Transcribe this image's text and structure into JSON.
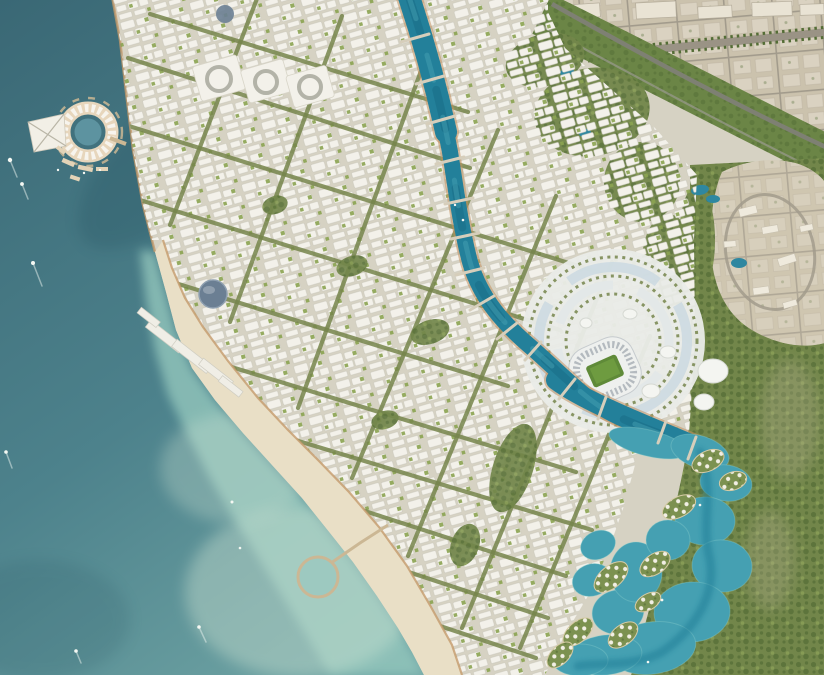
{
  "scene": {
    "title": "Coastal city masterplan — aerial render",
    "description": "Bird's-eye architectural rendering of a new waterfront city: dark teal sea with boats on the left, a circular marina island resort connected to shore, a dense white low-rise city crossed by tree-lined boulevards, a winding turquoise canal flowing from the north down past a stadium entertainment district, a crescent beach with a circular swimming pier, a mangrove lagoon with villa islands in the south-east, a green parkway belt separating the new city from an existing beige desert town in the north-east, and a rocky hillside village on the eastern edge.",
    "landmarks": [
      "circular marina island resort",
      "triangular barge pier",
      "winding central canal with bridges",
      "stadium with green pitch and sports district",
      "white dome venues",
      "crescent beach with circular pier",
      "lagoon with villa islands",
      "mangrove forest",
      "desert town grid (north-east)",
      "green parkway belt with highway",
      "hillside village (east)",
      "blue dome landmark building",
      "courtyard superblocks",
      "boats with wakes"
    ]
  },
  "palette": {
    "ocean_deep": "#3a6875",
    "ocean_mid": "#4d828c",
    "ocean_light": "#79aeab",
    "water_shadow": "#1f4a59",
    "shallow": "#93c6bc",
    "sand_shallow": "#cfe4d3",
    "sand": "#e9dfc6",
    "coast_edge": "#c49a6a",
    "ground": "#d6d2c3",
    "building": "#f3f1ea",
    "green_street": "#75854b",
    "green_park": "#8ba351",
    "green_dark": "#546d36",
    "forest": "#72864a",
    "belt": "#6b8546",
    "highway": "#7e8073",
    "canal": "#23809a",
    "canal_deep": "#14607a",
    "canal_light": "#4aa4b6",
    "canal_bank": "#c1905f",
    "lagoon": "#45a0b2",
    "lagoon_deep": "#1e7c95",
    "desert": "#cbc2ad",
    "desert_plot": "#ddd6c6",
    "desert_road": "#a29b8c",
    "rock": "#cfc6b0",
    "plaza": "#e9ebe7",
    "plaza_blue": "#c9d8e1",
    "stands": "#eef0ee",
    "stands_ring": "#a9b0b6",
    "pitch": "#5f8a38",
    "pitch_light": "#73a043",
    "marina_ring": "#e7d6bc",
    "marina_white": "#f7f4ed",
    "pier_tan": "#cbb794",
    "dome_blue": "#6b7f93",
    "villa_green": "#7c9150",
    "forest_road": "#b3a98d",
    "boat": "#f5f8f3"
  },
  "features": {
    "boulevards": [
      {
        "tag": "line",
        "x1": 150,
        "y1": 14,
        "x2": 468,
        "y2": 112
      },
      {
        "tag": "line",
        "x1": 128,
        "y1": 58,
        "x2": 470,
        "y2": 168
      },
      {
        "tag": "line",
        "x1": 116,
        "y1": 122,
        "x2": 604,
        "y2": 274
      },
      {
        "tag": "line",
        "x1": 140,
        "y1": 200,
        "x2": 560,
        "y2": 330
      },
      {
        "tag": "line",
        "x1": 172,
        "y1": 282,
        "x2": 508,
        "y2": 386
      },
      {
        "tag": "line",
        "x1": 215,
        "y1": 362,
        "x2": 576,
        "y2": 472
      },
      {
        "tag": "line",
        "x1": 262,
        "y1": 430,
        "x2": 592,
        "y2": 530
      },
      {
        "tag": "line",
        "x1": 312,
        "y1": 494,
        "x2": 566,
        "y2": 576
      },
      {
        "tag": "line",
        "x1": 360,
        "y1": 556,
        "x2": 548,
        "y2": 618
      },
      {
        "tag": "line",
        "x1": 404,
        "y1": 614,
        "x2": 536,
        "y2": 658
      },
      {
        "tag": "line",
        "x1": 258,
        "y1": -4,
        "x2": 170,
        "y2": 225
      },
      {
        "tag": "line",
        "x1": 342,
        "y1": 16,
        "x2": 230,
        "y2": 322
      },
      {
        "tag": "line",
        "x1": 425,
        "y1": 60,
        "x2": 298,
        "y2": 408
      },
      {
        "tag": "line",
        "x1": 498,
        "y1": 130,
        "x2": 352,
        "y2": 478
      },
      {
        "tag": "line",
        "x1": 556,
        "y1": 196,
        "x2": 408,
        "y2": 556
      },
      {
        "tag": "line",
        "x1": 612,
        "y1": 262,
        "x2": 462,
        "y2": 628
      },
      {
        "tag": "line",
        "x1": 650,
        "y1": 336,
        "x2": 520,
        "y2": 648
      }
    ],
    "bridges": [
      {
        "tag": "line",
        "x1": 401,
        "y1": 42,
        "x2": 429,
        "y2": 34
      },
      {
        "tag": "line",
        "x1": 416,
        "y1": 84,
        "x2": 444,
        "y2": 76
      },
      {
        "tag": "line",
        "x1": 427,
        "y1": 124,
        "x2": 455,
        "y2": 116
      },
      {
        "tag": "line",
        "x1": 436,
        "y1": 164,
        "x2": 464,
        "y2": 157
      },
      {
        "tag": "line",
        "x1": 445,
        "y1": 204,
        "x2": 473,
        "y2": 198
      },
      {
        "tag": "line",
        "x1": 451,
        "y1": 239,
        "x2": 479,
        "y2": 233
      },
      {
        "tag": "line",
        "x1": 456,
        "y1": 275,
        "x2": 484,
        "y2": 268
      },
      {
        "tag": "line",
        "x1": 470,
        "y1": 310,
        "x2": 494,
        "y2": 296
      },
      {
        "tag": "line",
        "x1": 497,
        "y1": 339,
        "x2": 517,
        "y2": 323
      },
      {
        "tag": "line",
        "x1": 525,
        "y1": 360,
        "x2": 541,
        "y2": 342
      },
      {
        "tag": "line",
        "x1": 559,
        "y1": 399,
        "x2": 575,
        "y2": 379
      },
      {
        "tag": "line",
        "x1": 598,
        "y1": 419,
        "x2": 606,
        "y2": 397
      },
      {
        "tag": "line",
        "x1": 658,
        "y1": 443,
        "x2": 666,
        "y2": 421
      },
      {
        "tag": "line",
        "x1": 688,
        "y1": 459,
        "x2": 696,
        "y2": 437
      }
    ],
    "lagoon_pools": [
      {
        "tag": "ellipse",
        "cx": 648,
        "cy": 443,
        "rx": 40,
        "ry": 13,
        "transform": "rotate(14 648 443)"
      },
      {
        "tag": "ellipse",
        "cx": 700,
        "cy": 452,
        "rx": 30,
        "ry": 16,
        "transform": "rotate(18 700 452)"
      },
      {
        "tag": "ellipse",
        "cx": 726,
        "cy": 483,
        "rx": 26,
        "ry": 18,
        "transform": "rotate(8 726 483)"
      },
      {
        "tag": "ellipse",
        "cx": 705,
        "cy": 521,
        "rx": 30,
        "ry": 24
      },
      {
        "tag": "ellipse",
        "cx": 722,
        "cy": 566,
        "rx": 30,
        "ry": 26,
        "transform": "rotate(6 722 566)"
      },
      {
        "tag": "ellipse",
        "cx": 692,
        "cy": 612,
        "rx": 38,
        "ry": 30,
        "transform": "rotate(-4 692 612)"
      },
      {
        "tag": "ellipse",
        "cx": 652,
        "cy": 648,
        "rx": 44,
        "ry": 26,
        "transform": "rotate(-8 652 648)"
      },
      {
        "tag": "ellipse",
        "cx": 606,
        "cy": 655,
        "rx": 36,
        "ry": 20,
        "transform": "rotate(-6 606 655)"
      },
      {
        "tag": "ellipse",
        "cx": 580,
        "cy": 660,
        "rx": 28,
        "ry": 16
      },
      {
        "tag": "ellipse",
        "cx": 618,
        "cy": 612,
        "rx": 26,
        "ry": 22,
        "transform": "rotate(-12 618 612)"
      },
      {
        "tag": "ellipse",
        "cx": 592,
        "cy": 580,
        "rx": 20,
        "ry": 16,
        "transform": "rotate(-18 592 580)"
      },
      {
        "tag": "ellipse",
        "cx": 598,
        "cy": 545,
        "rx": 18,
        "ry": 14,
        "transform": "rotate(-24 598 545)"
      },
      {
        "tag": "ellipse",
        "cx": 636,
        "cy": 572,
        "rx": 26,
        "ry": 30
      },
      {
        "tag": "ellipse",
        "cx": 668,
        "cy": 540,
        "rx": 22,
        "ry": 20
      }
    ],
    "villa_islands": [
      {
        "tag": "ellipse",
        "cx": 708,
        "cy": 461,
        "rx": 17,
        "ry": 10,
        "transform": "rotate(-25 708 461)"
      },
      {
        "tag": "ellipse",
        "cx": 733,
        "cy": 481,
        "rx": 14,
        "ry": 9,
        "transform": "rotate(-18 733 481)"
      },
      {
        "tag": "ellipse",
        "cx": 679,
        "cy": 507,
        "rx": 18,
        "ry": 10,
        "transform": "rotate(-28 679 507)"
      },
      {
        "tag": "ellipse",
        "cx": 655,
        "cy": 564,
        "rx": 17,
        "ry": 10,
        "transform": "rotate(-35 655 564)"
      },
      {
        "tag": "ellipse",
        "cx": 611,
        "cy": 577,
        "rx": 20,
        "ry": 11,
        "transform": "rotate(-40 611 577)"
      },
      {
        "tag": "ellipse",
        "cx": 578,
        "cy": 632,
        "rx": 18,
        "ry": 10,
        "transform": "rotate(-42 578 632)"
      },
      {
        "tag": "ellipse",
        "cx": 623,
        "cy": 635,
        "rx": 17,
        "ry": 10,
        "transform": "rotate(-38 623 635)"
      },
      {
        "tag": "ellipse",
        "cx": 648,
        "cy": 602,
        "rx": 14,
        "ry": 8,
        "transform": "rotate(-30 648 602)"
      },
      {
        "tag": "ellipse",
        "cx": 560,
        "cy": 655,
        "rx": 16,
        "ry": 9,
        "transform": "rotate(-45 560 655)"
      }
    ],
    "parks": [
      {
        "tag": "ellipse",
        "cx": 513,
        "cy": 468,
        "rx": 20,
        "ry": 46,
        "transform": "rotate(18 513 468)"
      },
      {
        "tag": "ellipse",
        "cx": 430,
        "cy": 332,
        "rx": 20,
        "ry": 12,
        "transform": "rotate(-18 430 332)"
      },
      {
        "tag": "ellipse",
        "cx": 352,
        "cy": 266,
        "rx": 16,
        "ry": 10,
        "transform": "rotate(-18 352 266)"
      },
      {
        "tag": "ellipse",
        "cx": 275,
        "cy": 205,
        "rx": 13,
        "ry": 9,
        "transform": "rotate(-18 275 205)"
      },
      {
        "tag": "ellipse",
        "cx": 465,
        "cy": 545,
        "rx": 14,
        "ry": 22,
        "transform": "rotate(20 465 545)"
      },
      {
        "tag": "ellipse",
        "cx": 385,
        "cy": 420,
        "rx": 14,
        "ry": 9,
        "transform": "rotate(-18 385 420)"
      }
    ],
    "green_hills": [
      {
        "tag": "ellipse",
        "cx": 592,
        "cy": 112,
        "rx": 58,
        "ry": 44,
        "transform": "rotate(-10 592 112)"
      },
      {
        "tag": "ellipse",
        "cx": 545,
        "cy": 60,
        "rx": 40,
        "ry": 26,
        "transform": "rotate(-15 545 60)"
      },
      {
        "tag": "ellipse",
        "cx": 642,
        "cy": 182,
        "rx": 38,
        "ry": 40
      },
      {
        "tag": "ellipse",
        "cx": 668,
        "cy": 262,
        "rx": 26,
        "ry": 48
      },
      {
        "tag": "ellipse",
        "cx": 697,
        "cy": 240,
        "rx": 18,
        "ry": 55
      }
    ],
    "ponds": [
      {
        "tag": "ellipse",
        "cx": 700,
        "cy": 190,
        "rx": 9,
        "ry": 5,
        "transform": "rotate(-10 700 190)"
      },
      {
        "tag": "ellipse",
        "cx": 713,
        "cy": 199,
        "rx": 7,
        "ry": 4
      },
      {
        "tag": "ellipse",
        "cx": 739,
        "cy": 263,
        "rx": 8,
        "ry": 5
      },
      {
        "tag": "ellipse",
        "cx": 567,
        "cy": 72,
        "rx": 7,
        "ry": 4,
        "transform": "rotate(-15 567 72)"
      },
      {
        "tag": "ellipse",
        "cx": 585,
        "cy": 133,
        "rx": 6,
        "ry": 4,
        "transform": "rotate(-10 585 133)"
      }
    ],
    "venues": [
      {
        "tag": "ellipse",
        "cx": 651,
        "cy": 391,
        "rx": 9,
        "ry": 7
      },
      {
        "tag": "ellipse",
        "cx": 668,
        "cy": 352,
        "rx": 8,
        "ry": 6
      },
      {
        "tag": "ellipse",
        "cx": 713,
        "cy": 371,
        "rx": 15,
        "ry": 12
      },
      {
        "tag": "ellipse",
        "cx": 704,
        "cy": 402,
        "rx": 10,
        "ry": 8
      },
      {
        "tag": "ellipse",
        "cx": 630,
        "cy": 314,
        "rx": 7,
        "ry": 5
      },
      {
        "tag": "ellipse",
        "cx": 586,
        "cy": 323,
        "rx": 6,
        "ry": 5
      }
    ],
    "coast_slabs": [
      {
        "tag": "rect",
        "x": 144,
        "y": 332,
        "width": 42,
        "height": 9,
        "transform": "rotate(38 165 336)"
      },
      {
        "tag": "rect",
        "x": 170,
        "y": 352,
        "width": 44,
        "height": 9,
        "transform": "rotate(38 192 356)"
      },
      {
        "tag": "rect",
        "x": 197,
        "y": 369,
        "width": 38,
        "height": 8,
        "transform": "rotate(38 216 373)"
      },
      {
        "tag": "rect",
        "x": 137,
        "y": 314,
        "width": 24,
        "height": 7,
        "transform": "rotate(38 149 317)"
      },
      {
        "tag": "rect",
        "x": 218,
        "y": 383,
        "width": 26,
        "height": 7,
        "transform": "rotate(38 231 386)"
      }
    ],
    "court_blocks": [
      {
        "tag": "rect",
        "x": 196,
        "y": 60,
        "width": 46,
        "height": 36,
        "rx": 3,
        "transform": "rotate(-16 219 78)"
      },
      {
        "tag": "rect",
        "x": 244,
        "y": 64,
        "width": 44,
        "height": 34,
        "rx": 3,
        "transform": "rotate(-16 266 81)"
      },
      {
        "tag": "rect",
        "x": 289,
        "y": 70,
        "width": 42,
        "height": 33,
        "rx": 3,
        "transform": "rotate(-16 310 86)"
      }
    ],
    "court_rings": [
      {
        "tag": "circle",
        "cx": 219,
        "cy": 79,
        "r": 12
      },
      {
        "tag": "circle",
        "cx": 266,
        "cy": 82,
        "r": 11
      },
      {
        "tag": "circle",
        "cx": 310,
        "cy": 87,
        "r": 11
      }
    ],
    "marina_docks": [
      {
        "tag": "rect",
        "x": 62,
        "y": 160,
        "width": 13,
        "height": 4.5,
        "transform": "rotate(24 68 162)"
      },
      {
        "tag": "rect",
        "x": 78,
        "y": 166,
        "width": 15,
        "height": 4.5,
        "transform": "rotate(12 85 168)"
      },
      {
        "tag": "rect",
        "x": 96,
        "y": 167,
        "width": 12,
        "height": 4
      },
      {
        "tag": "rect",
        "x": 56,
        "y": 148,
        "width": 10,
        "height": 4,
        "transform": "rotate(38 61 150)"
      },
      {
        "tag": "rect",
        "x": 70,
        "y": 176,
        "width": 10,
        "height": 4,
        "transform": "rotate(18 75 178)"
      }
    ],
    "desert_blocks": [
      {
        "tag": "rect",
        "x": 566,
        "y": 4,
        "width": 34,
        "height": 14,
        "transform": "rotate(-4 583 11)"
      },
      {
        "tag": "rect",
        "x": 636,
        "y": 2,
        "width": 40,
        "height": 16,
        "transform": "rotate(-3 656 10)"
      },
      {
        "tag": "rect",
        "x": 698,
        "y": 6,
        "width": 34,
        "height": 12,
        "transform": "rotate(-3 715 12)"
      },
      {
        "tag": "rect",
        "x": 752,
        "y": 2,
        "width": 40,
        "height": 14,
        "transform": "rotate(-2 772 9)"
      },
      {
        "tag": "rect",
        "x": 800,
        "y": 4,
        "width": 24,
        "height": 11,
        "transform": "rotate(-2 812 9)"
      }
    ],
    "rock_buildings": [
      {
        "tag": "rect",
        "x": 739,
        "y": 207,
        "width": 18,
        "height": 8,
        "transform": "rotate(-14 748 211)"
      },
      {
        "tag": "rect",
        "x": 762,
        "y": 226,
        "width": 16,
        "height": 7,
        "transform": "rotate(-10 770 229)"
      },
      {
        "tag": "rect",
        "x": 778,
        "y": 256,
        "width": 18,
        "height": 8,
        "transform": "rotate(-18 787 260)"
      },
      {
        "tag": "rect",
        "x": 753,
        "y": 287,
        "width": 16,
        "height": 7,
        "transform": "rotate(-8 761 290)"
      },
      {
        "tag": "rect",
        "x": 783,
        "y": 301,
        "width": 14,
        "height": 6,
        "transform": "rotate(-16 790 304)"
      },
      {
        "tag": "rect",
        "x": 724,
        "y": 241,
        "width": 12,
        "height": 6,
        "transform": "rotate(-5 730 244)"
      },
      {
        "tag": "rect",
        "x": 800,
        "y": 225,
        "width": 13,
        "height": 6,
        "transform": "rotate(-12 806 228)"
      }
    ],
    "boat_wakes": [
      {
        "tag": "line",
        "x1": 10,
        "y1": 160,
        "x2": 17,
        "y2": 177
      },
      {
        "tag": "line",
        "x1": 22,
        "y1": 184,
        "x2": 28,
        "y2": 199
      },
      {
        "tag": "line",
        "x1": 33,
        "y1": 263,
        "x2": 42,
        "y2": 286
      },
      {
        "tag": "line",
        "x1": 6,
        "y1": 452,
        "x2": 12,
        "y2": 468
      },
      {
        "tag": "line",
        "x1": 76,
        "y1": 651,
        "x2": 81,
        "y2": 663
      },
      {
        "tag": "line",
        "x1": 199,
        "y1": 627,
        "x2": 206,
        "y2": 642
      }
    ],
    "boats": [
      {
        "tag": "circle",
        "cx": 10,
        "cy": 160,
        "r": 2.2
      },
      {
        "tag": "circle",
        "cx": 22,
        "cy": 184,
        "r": 1.9
      },
      {
        "tag": "circle",
        "cx": 33,
        "cy": 263,
        "r": 2
      },
      {
        "tag": "circle",
        "cx": 6,
        "cy": 452,
        "r": 1.8
      },
      {
        "tag": "circle",
        "cx": 76,
        "cy": 651,
        "r": 1.8
      },
      {
        "tag": "circle",
        "cx": 199,
        "cy": 627,
        "r": 1.8
      },
      {
        "tag": "circle",
        "cx": 232,
        "cy": 502,
        "r": 1.5
      },
      {
        "tag": "circle",
        "cx": 240,
        "cy": 548,
        "r": 1.3
      },
      {
        "tag": "circle",
        "cx": 58,
        "cy": 170,
        "r": 1.2
      },
      {
        "tag": "circle",
        "cx": 84,
        "cy": 173,
        "r": 1.2
      },
      {
        "tag": "circle",
        "cx": 100,
        "cy": 170,
        "r": 1.1
      },
      {
        "tag": "circle",
        "cx": 463,
        "cy": 220,
        "r": 1.3
      },
      {
        "tag": "circle",
        "cx": 455,
        "cy": 205,
        "r": 1.2
      },
      {
        "tag": "circle",
        "cx": 662,
        "cy": 600,
        "r": 1.4
      },
      {
        "tag": "circle",
        "cx": 700,
        "cy": 505,
        "r": 1.3
      },
      {
        "tag": "circle",
        "cx": 648,
        "cy": 662,
        "r": 1.3
      }
    ]
  }
}
